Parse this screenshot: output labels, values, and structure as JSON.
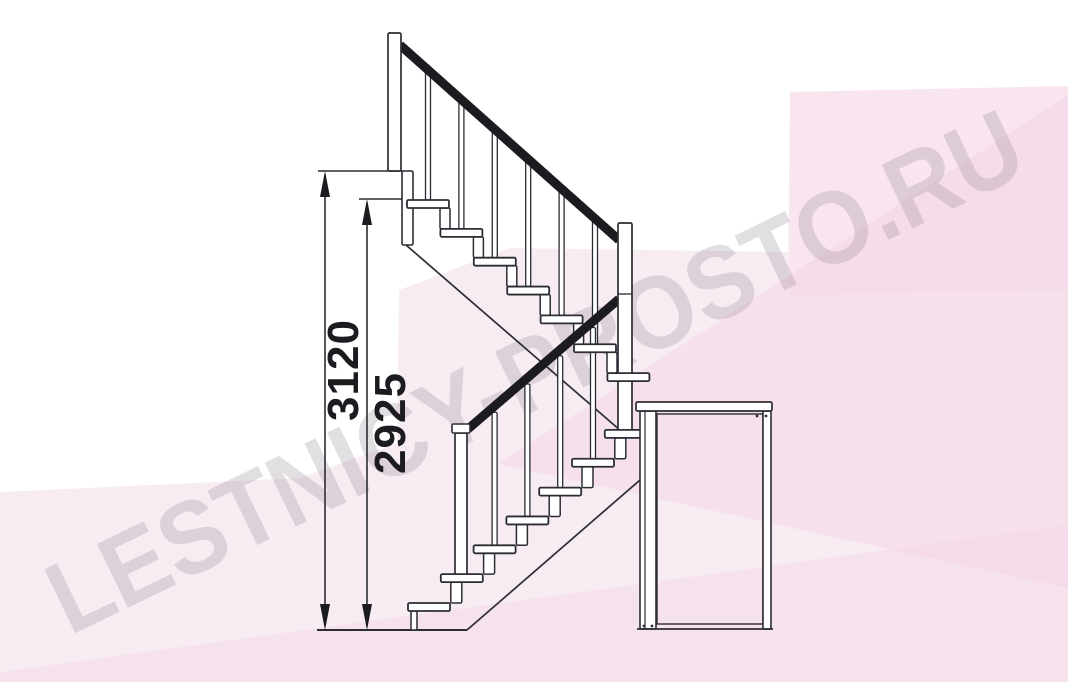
{
  "meta": {
    "width": 1068,
    "height": 682,
    "kind": "staircase-elevation-drawing"
  },
  "watermark": {
    "text": "LESTNICY-PROSTO.RU"
  },
  "dimensions": [
    {
      "label": "3120",
      "x": 325,
      "y_top": 171,
      "y_bottom": 630,
      "ext": [
        318,
        171,
        403,
        171
      ],
      "label_cx": 344,
      "label_cy": 370
    },
    {
      "label": "2925",
      "x": 367,
      "y_top": 199,
      "y_bottom": 630,
      "ext": [
        359,
        199,
        412,
        199
      ],
      "label_cx": 391,
      "label_cy": 423
    }
  ],
  "colors": {
    "line": "#2c2c34",
    "rail": "#1b1b20",
    "fill": "#ffffff",
    "pink_main": "#f8ecf3",
    "pink_wedge": "rgba(241,205,226,0.38)",
    "pink_bottom": "rgba(243,211,229,0.42)",
    "pink_topright": "rgba(247,202,224,0.18)"
  },
  "background_polygons": {
    "main": "0,492 300,478 397,443 399,290 510,248 788,252 790,92 1068,86 1068,682 0,682",
    "wedge": "498,464 1068,95 1068,588",
    "bottom_band": "0,672 1068,525 1068,682 0,682",
    "topright_patch": "790,92 1068,86 1068,290 790,295"
  },
  "figure": {
    "floor": {
      "x1": 317,
      "x2": 467,
      "y": 630
    },
    "upper_flight": {
      "n": 7,
      "x0": 407,
      "y0": 200,
      "dx": 33.4,
      "dy": 28.85,
      "sw": 42,
      "sh": 8,
      "stringer": [
        406,
        245,
        621,
        431
      ],
      "conn_off": 33,
      "conn_w": 10,
      "bal_off": 18.5,
      "bal_w": 5,
      "bal_ks": [
        0,
        1,
        2,
        3,
        4,
        5
      ]
    },
    "lower_flight": {
      "n": 7,
      "x0": 408,
      "y0": 603,
      "dx": 32.8,
      "dy": -28.85,
      "sw": 42,
      "sh": 8,
      "stringer": [
        467,
        630,
        640,
        480
      ],
      "support": [
        411,
        611,
        6,
        19
      ],
      "conn_off": 10,
      "conn_w": 11,
      "bal_off": 18.5,
      "bal_w": 5,
      "bal_ks": [
        2,
        3,
        4,
        5,
        6
      ]
    },
    "rails": {
      "upper": [
        400,
        45,
        619,
        240
      ],
      "lower": [
        468,
        429,
        619,
        299
      ],
      "w": 9
    },
    "posts": {
      "landing_newel": [
        388,
        33,
        13,
        138
      ],
      "riser_board": [
        402,
        171,
        11,
        74
      ],
      "platform_newel": [
        618,
        223,
        14,
        207
      ],
      "platform_newel_joint_y": 294,
      "bottom_newel_cap": [
        452,
        424,
        18,
        9
      ],
      "bottom_newel": [
        455,
        433,
        12,
        143
      ]
    },
    "platform": {
      "plate": [
        636,
        402,
        136,
        9
      ],
      "left_leg": [
        640,
        411,
        16,
        218
      ],
      "left_leg_inner_x": 645,
      "right_leg": [
        763,
        411,
        8,
        218
      ],
      "inner": [
        657,
        414,
        106,
        210
      ],
      "bottom_line": [
        637,
        629,
        773,
        629
      ],
      "dots": [
        [
          644,
          626
        ],
        [
          652,
          626
        ],
        [
          757,
          416
        ],
        [
          766,
          416
        ]
      ]
    }
  }
}
